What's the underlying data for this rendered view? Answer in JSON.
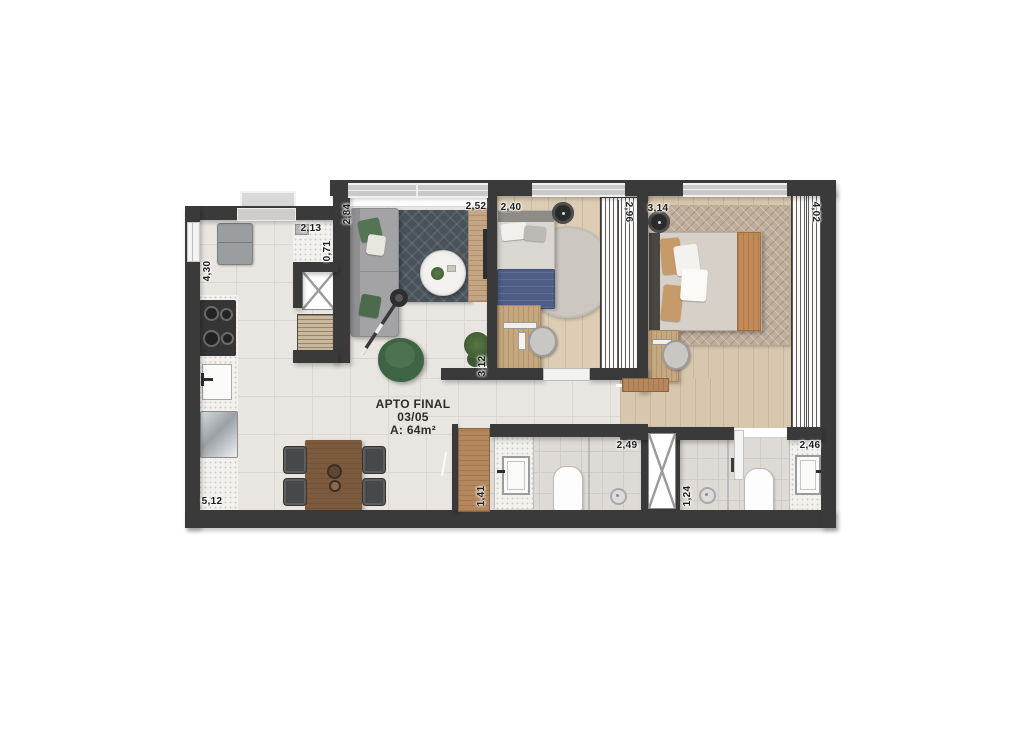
{
  "title": {
    "line1": "APTO FINAL",
    "line2": "03/05",
    "line3": "A: 64m²"
  },
  "dimensions": [
    {
      "name": "counter-width",
      "text": "2,13"
    },
    {
      "name": "counter-depth",
      "text": "0,71"
    },
    {
      "name": "kitchen-depth",
      "text": "4,30"
    },
    {
      "name": "kitchen-length",
      "text": "5,12"
    },
    {
      "name": "living-sofa-wall",
      "text": "2,84"
    },
    {
      "name": "living-width",
      "text": "2,52"
    },
    {
      "name": "bedroom1-width",
      "text": "2,40"
    },
    {
      "name": "bedroom1-closet",
      "text": "2,96"
    },
    {
      "name": "bedroom2-width",
      "text": "3,14"
    },
    {
      "name": "bedroom2-closet",
      "text": "4,02"
    },
    {
      "name": "hall-length",
      "text": "3,12"
    },
    {
      "name": "bathroom1-width",
      "text": "1,41"
    },
    {
      "name": "bathroom1-length",
      "text": "2,49"
    },
    {
      "name": "bathroom2-width",
      "text": "1,24"
    },
    {
      "name": "bathroom2-vanity",
      "text": "2,46"
    }
  ],
  "colors": {
    "wall": "#3a3a3a",
    "floor_tile": "#e9e6e1",
    "wood_floor": "#d9c9b0",
    "rug_dark": "#49525a",
    "rug_tan": "#bfae9b",
    "accent_green": "#47684a",
    "accent_blue": "#4f5e85",
    "marble": "#f2f1ee",
    "door_wood": "#b5875d"
  }
}
